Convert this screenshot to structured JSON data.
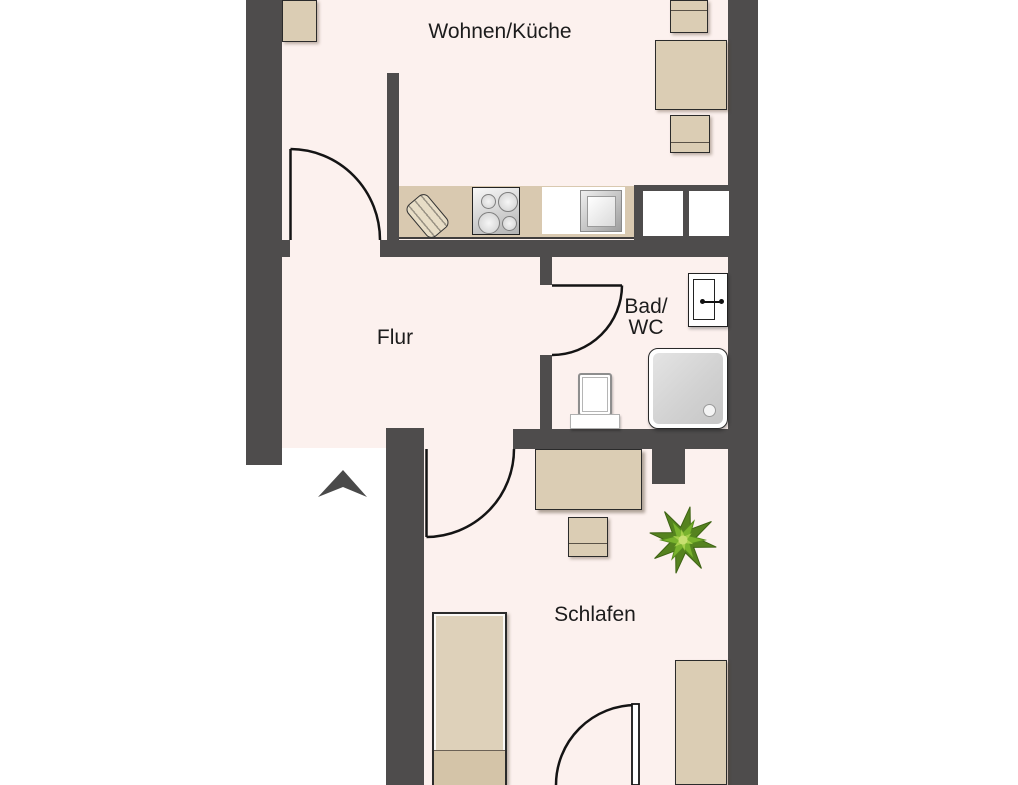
{
  "floorplan": {
    "type": "apartment-floor-plan",
    "rooms": [
      {
        "id": "wohnen-kueche",
        "label": "Wohnen/Küche"
      },
      {
        "id": "flur",
        "label": "Flur"
      },
      {
        "id": "bad-wc",
        "label_line1": "Bad/",
        "label_line2": "WC"
      },
      {
        "id": "schlafen",
        "label": "Schlafen"
      }
    ],
    "entrance": {
      "marker": "arrow",
      "direction": "up",
      "location": "below-flur"
    },
    "doors": [
      {
        "from": "flur",
        "to": "wohnen-kueche"
      },
      {
        "from": "flur",
        "to": "bad-wc"
      },
      {
        "from": "flur",
        "to": "schlafen"
      },
      {
        "from": "outside-bottom",
        "to": "schlafen"
      }
    ],
    "furniture": {
      "wohnen_kueche": [
        "wardrobe",
        "dining-table",
        "dining-chair",
        "dining-chair",
        "kitchen-counter",
        "cutting-board",
        "cooktop-4-burners",
        "kitchen-sink",
        "shaft-two-white-squares"
      ],
      "bad_wc": [
        "bathroom-cabinet",
        "toilet",
        "shower"
      ],
      "schlafen": [
        "desk",
        "desk-chair",
        "potted-plant",
        "single-bed",
        "wardrobe"
      ]
    },
    "colors": {
      "wall": "#4e4c4c",
      "floor": "#fcf1ee",
      "outside": "#ffffff",
      "furniture": "#dbcdb4",
      "counter": "#d9c9b0",
      "door_line": "#141414",
      "text": "#1c1c1c",
      "shower_tray": "#d5d5d5",
      "plant_green": "#7ab32e",
      "entrance_arrow": "#4a4a4a"
    }
  }
}
